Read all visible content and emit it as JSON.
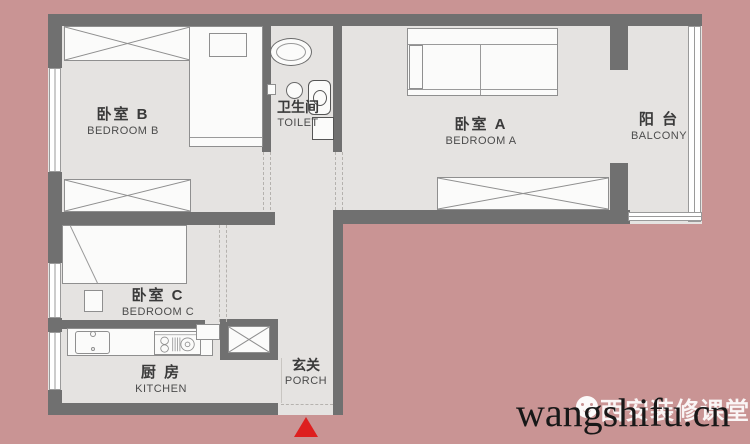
{
  "title": "apartment-floor-plan",
  "colors": {
    "background": "#c99494",
    "floor": "#e5e3e1",
    "wall": "#707070",
    "entrance_marker": "#de1f1f"
  },
  "rooms": [
    {
      "id": "bedroom-b",
      "zh": "卧室 B",
      "en": "BEDROOM B"
    },
    {
      "id": "toilet",
      "zh": "卫生间",
      "en": "TOILET"
    },
    {
      "id": "bedroom-a",
      "zh": "卧室 A",
      "en": "BEDROOM A"
    },
    {
      "id": "balcony",
      "zh": "阳 台",
      "en": "BALCONY"
    },
    {
      "id": "bedroom-c",
      "zh": "卧室 C",
      "en": "BEDROOM C"
    },
    {
      "id": "kitchen",
      "zh": "厨 房",
      "en": "KITCHEN"
    },
    {
      "id": "porch",
      "zh": "玄关",
      "en": "PORCH"
    }
  ],
  "watermark": {
    "main": "wangshifu.cn",
    "overlay_zh": "西安装修课堂",
    "icon": "wechat-face-icon"
  }
}
